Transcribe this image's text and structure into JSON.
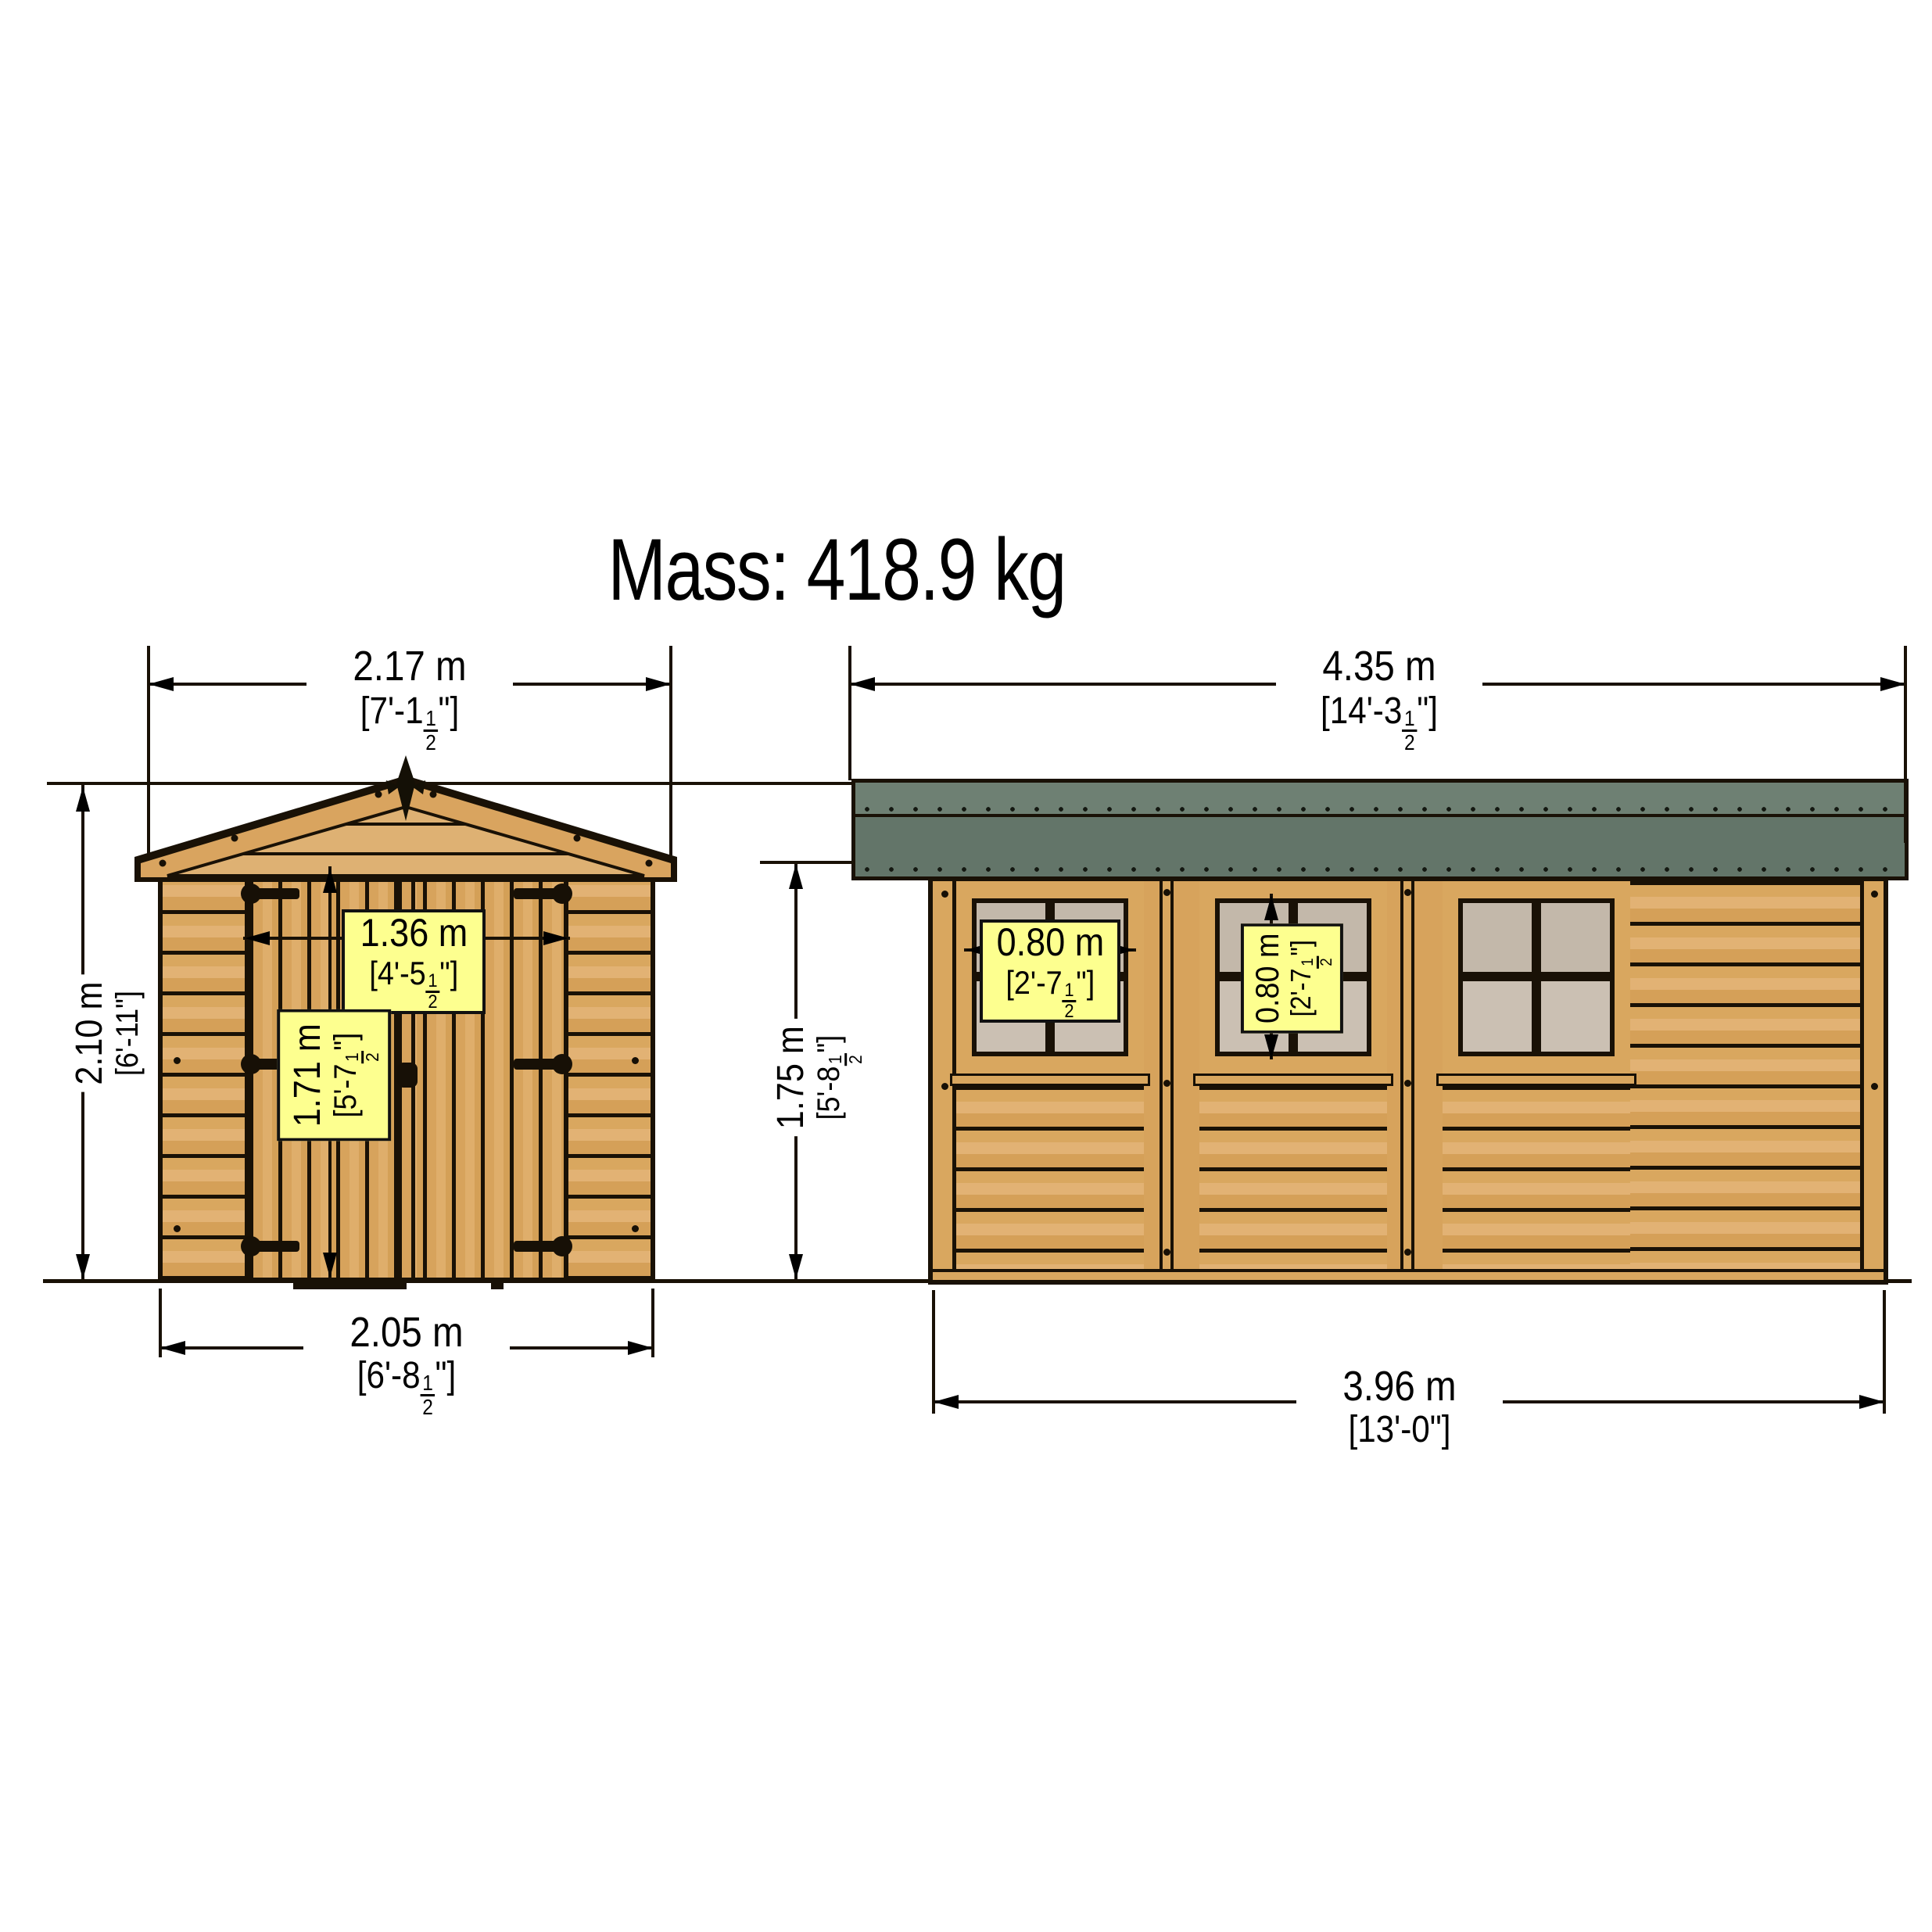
{
  "title": "Mass: 418.9 kg",
  "colors": {
    "wood": "#d7a45e",
    "wood_light": "#e0b175",
    "outline": "#191106",
    "roof_upper": "#6e8073",
    "roof_lower": "#637569",
    "window_pane": "#cbc0b3",
    "label_bg": "#fdff8f",
    "background": "#ffffff"
  },
  "front_view": {
    "dims": {
      "roof_width": {
        "metric": "2.17 m",
        "imperial": {
          "pre": "[7'-1",
          "num": "1",
          "den": "2",
          "post": "\"]"
        }
      },
      "overall_height": {
        "metric": "2.10 m",
        "imperial": {
          "pre": "[6'-11",
          "post": "\"]"
        }
      },
      "door_width": {
        "metric": "1.36 m",
        "imperial": {
          "pre": "[4'-5",
          "num": "1",
          "den": "2",
          "post": "\"]"
        }
      },
      "door_height": {
        "metric": "1.71 m",
        "imperial": {
          "pre": "[5'-7",
          "num": "1",
          "den": "2",
          "post": "\"]"
        }
      },
      "base_width": {
        "metric": "2.05 m",
        "imperial": {
          "pre": "[6'-8",
          "num": "1",
          "den": "2",
          "post": "\"]"
        }
      }
    }
  },
  "side_view": {
    "dims": {
      "roof_length": {
        "metric": "4.35 m",
        "imperial": {
          "pre": "[14'-3",
          "num": "1",
          "den": "2",
          "post": "\"]"
        }
      },
      "wall_height": {
        "metric": "1.75 m",
        "imperial": {
          "pre": "[5'-8",
          "num": "1",
          "den": "2",
          "post": "\"]"
        }
      },
      "window_width": {
        "metric": "0.80 m",
        "imperial": {
          "pre": "[2'-7",
          "num": "1",
          "den": "2",
          "post": "\"]"
        }
      },
      "window_height": {
        "metric": "0.80 m",
        "imperial": {
          "pre": "[2'-7",
          "num": "1",
          "den": "2",
          "post": "\"]"
        }
      },
      "base_length": {
        "metric": "3.96 m",
        "imperial": {
          "pre": "[13'-0",
          "post": "\"]"
        }
      }
    }
  }
}
